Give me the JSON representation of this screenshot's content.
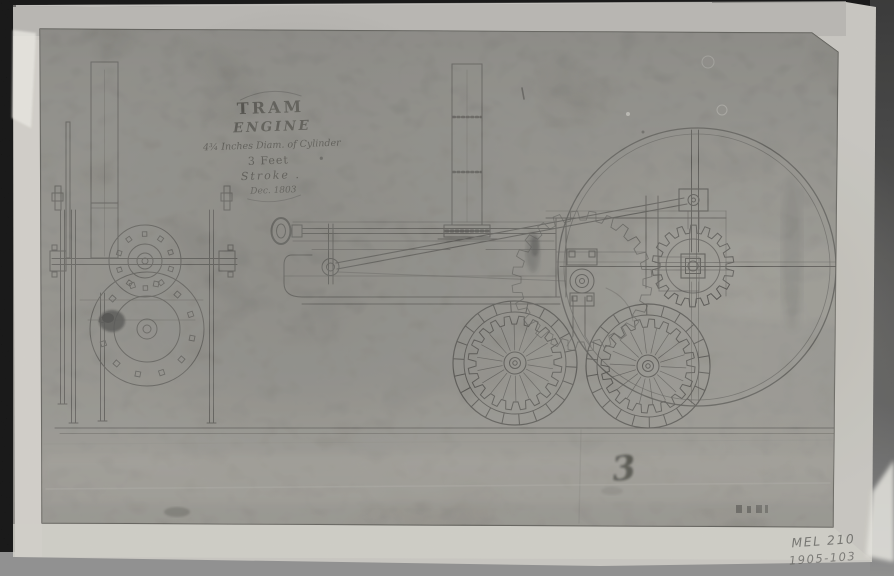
{
  "title_block": {
    "title": "TRAM",
    "subtitle": "ENGINE",
    "spec_line": "4¾ Inches Diam. of Cylinder",
    "stroke_value": "3 Feet",
    "stroke_label": "Stroke .",
    "date": "Dec. 1803"
  },
  "annotations": {
    "figure_number": "3",
    "catalog_ref_line1": "MEL 210",
    "catalog_ref_line2": "1905-103"
  },
  "colors": {
    "photo_border": "#070707",
    "table_surface": "#8c8c8c",
    "mount_paper": "#c8c6c0",
    "sheet_paper": "#807e78",
    "ink": "#2e2c29",
    "pencil": "#5e5e5b",
    "highlight_white": "#f0efeb"
  }
}
